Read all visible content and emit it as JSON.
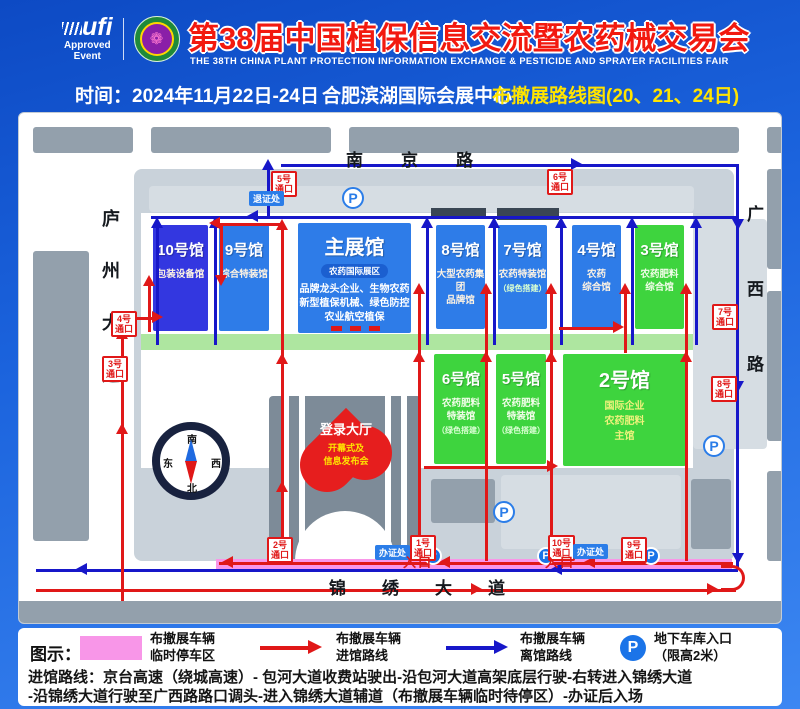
{
  "header": {
    "ufi_name": "ufi",
    "ufi_sub1": "Approved",
    "ufi_sub2": "Event",
    "emblem_glyph": "❁",
    "title": "第38届中国植保信息交流暨农药械交易会",
    "subtitle": "THE 38TH CHINA PLANT PROTECTION INFORMATION EXCHANGE & PESTICIDE AND SPRAYER FACILITIES FAIR"
  },
  "infobar": {
    "time_label": "时间：2024年11月22日-24日",
    "venue": "合肥滨湖国际会展中心",
    "route_title": "布撤展路线图(20、21、24日)"
  },
  "map": {
    "roads": {
      "north": "南京路",
      "west": "庐州大道",
      "east": "广西路",
      "south": "锦绣大道"
    },
    "halls": {
      "h10": {
        "name": "10号馆",
        "sub": "包装设备馆"
      },
      "h9": {
        "name": "9号馆",
        "sub": "综合特装馆"
      },
      "main": {
        "name": "主展馆",
        "badge": "农药国际展区",
        "line1": "品牌龙头企业、生物农药",
        "line2": "新型植保机械、绿色防控",
        "line3": "农业航空植保"
      },
      "h8": {
        "name": "8号馆",
        "sub1": "大型农药集团",
        "sub2": "品牌馆"
      },
      "h7": {
        "name": "7号馆",
        "sub1": "农药特装馆",
        "note": "（绿色搭建）"
      },
      "h4": {
        "name": "4号馆",
        "sub1": "农药",
        "sub2": "综合馆"
      },
      "h3": {
        "name": "3号馆",
        "sub1": "农药肥料",
        "sub2": "综合馆"
      },
      "h6": {
        "name": "6号馆",
        "sub1": "农药肥料",
        "sub2": "特装馆",
        "note": "（绿色搭建）"
      },
      "h5": {
        "name": "5号馆",
        "sub1": "农药肥料",
        "sub2": "特装馆",
        "note": "（绿色搭建）"
      },
      "h2": {
        "name": "2号馆",
        "sub1": "国际企业",
        "sub2": "农药肥料",
        "sub3": "主馆"
      }
    },
    "login_hall": {
      "title": "登录大厅",
      "sub1": "开幕式及",
      "sub2": "信息发布会"
    },
    "gates": {
      "g1": {
        "num": "1号",
        "word": "通口"
      },
      "g2": {
        "num": "2号",
        "word": "通口"
      },
      "g3": {
        "num": "3号",
        "word": "通口"
      },
      "g4": {
        "num": "4号",
        "word": "通口"
      },
      "g5": {
        "num": "5号",
        "word": "通口"
      },
      "g6": {
        "num": "6号",
        "word": "通口"
      },
      "g7": {
        "num": "7号",
        "word": "通口"
      },
      "g8": {
        "num": "8号",
        "word": "通口"
      },
      "g9": {
        "num": "9号",
        "word": "通口"
      },
      "g10": {
        "num": "10号",
        "word": "通口"
      }
    },
    "labels": {
      "checkin": "办证处",
      "checkout": "退证处",
      "entrance": "入口",
      "parking": "P"
    },
    "compass": {
      "top": "南",
      "bottom": "北",
      "left": "东",
      "right": "西"
    }
  },
  "legend": {
    "heading": "图示：",
    "item1_line1": "布撤展车辆",
    "item1_line2": "临时停车区",
    "item2_line1": "布撤展车辆",
    "item2_line2": "进馆路线",
    "item3_line1": "布撤展车辆",
    "item3_line2": "离馆路线",
    "parking": "P",
    "item4_line1": "地下车库入口",
    "item4_line2": "（限高2米）"
  },
  "route_text": {
    "line1": "进馆路线：京台高速（绕城高速）- 包河大道收费站驶出-沿包河大道高架底层行驶-右转进入锦绣大道",
    "line2": "-沿锦绣大道行驶至广西路路口调头-进入锦绣大道辅道（布撤展车辆临时待停区）-办证后入场"
  },
  "colors": {
    "accent_red": "#e01818",
    "route_blue": "#1717c9",
    "hall_blue": "#2e7ce8",
    "hall_deep_blue": "#3337e0",
    "hall_green": "#3ed43e",
    "pink_zone": "#f996e8",
    "header_blue": "#1b63dd",
    "yellow": "#ffe400"
  }
}
